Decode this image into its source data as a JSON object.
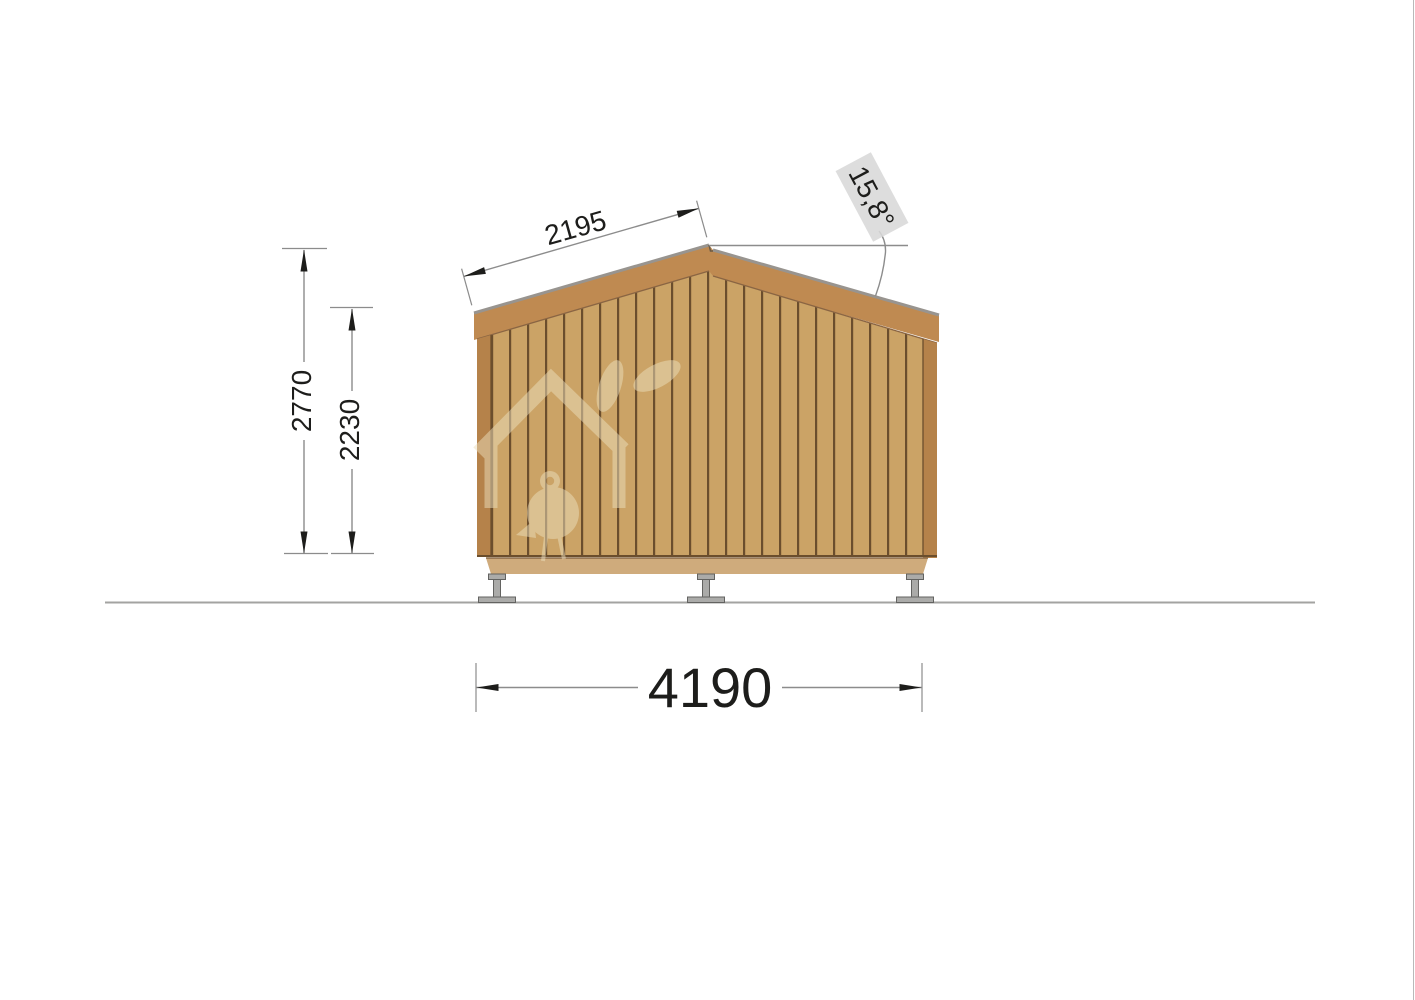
{
  "dimensions": {
    "roof_slope_length": "2195",
    "roof_angle": "15,8°",
    "overall_height": "2770",
    "wall_height": "2230",
    "overall_width": "4190"
  },
  "palette": {
    "wood": "#cba366",
    "wood-groove": "#6b4e2d",
    "fascia": "#bf8a51",
    "fascia-edge": "#8a6543",
    "trim": "#b5824a",
    "floor-band": "#cfab7c",
    "floor-band-edge": "#8a6b49",
    "roof-edge": "#98948f",
    "ridge-line": "#6a5a46",
    "foundation-fill": "#ababa9",
    "foundation-outline": "#636361",
    "ground-line": "#a3a3a1",
    "dim-line": "#8c8c8c",
    "dim-text": "#1d1d1b",
    "angle-label-bg": "#d8d8d8",
    "watermark": "#ecdfbd",
    "page-border": "#b9b9b9"
  }
}
